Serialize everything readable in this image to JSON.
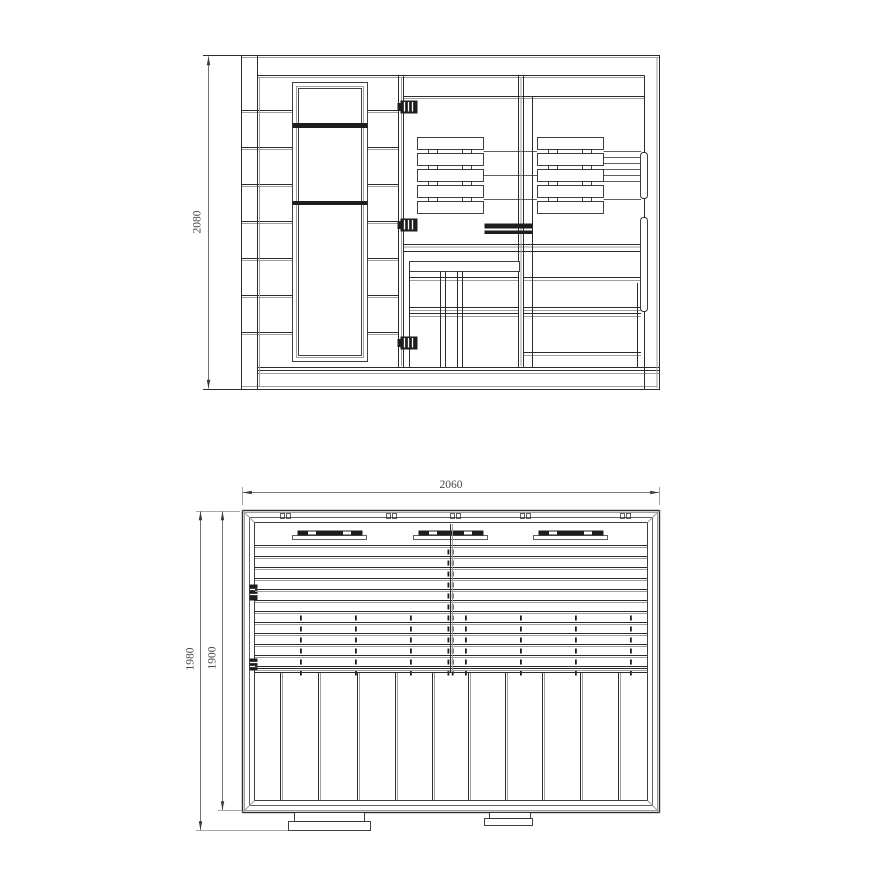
{
  "front_view": {
    "dimension_height": "2080"
  },
  "plan_view": {
    "dimension_width": "2060",
    "dimension_depth_overall": "1980",
    "dimension_depth_inner": "1900"
  },
  "colors": {
    "background": "#ffffff",
    "line_dark": "#2b2b2b",
    "line_light": "#9e9e9e",
    "fill_dark": "#1d1d1d",
    "dimension_text": "#4a4a4a"
  }
}
